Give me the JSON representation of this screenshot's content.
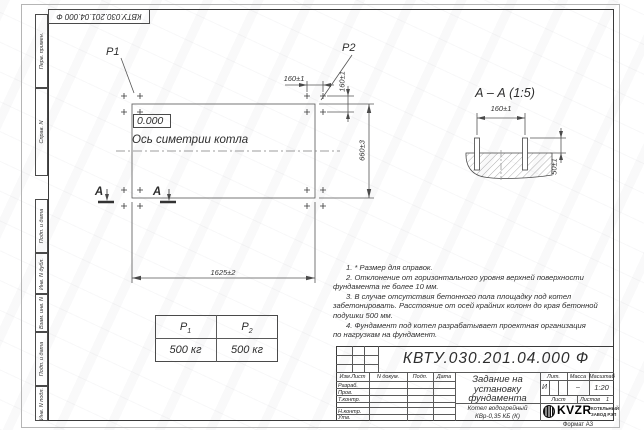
{
  "sheet": {
    "format_note": "Формат А3"
  },
  "margin_stamps": [
    "Перв. примен.",
    "Справ. N",
    "Подп. и дата",
    "Инв. N дубл.",
    "Взам. инв. N",
    "Подп. и дата",
    "Инв. N подл."
  ],
  "plan": {
    "p1_label": "P1",
    "p2_label": "P2",
    "level_mark": "0.000",
    "axis_label": "Ось симетрии котла",
    "dim_length": "1625±2",
    "dim_width": "660±3",
    "dim_bolt_h": "160±1",
    "dim_bolt_v": "160±1",
    "cut_letter": "А"
  },
  "section": {
    "title": "А – А (1:5)",
    "dim_bolt_spacing": "160±1",
    "dim_protrusion": "50±1"
  },
  "load_table": {
    "col1": {
      "base": "Р",
      "sub": "1",
      "value": "500 кг"
    },
    "col2": {
      "base": "Р",
      "sub": "2",
      "value": "500 кг"
    }
  },
  "notes": {
    "lines": [
      "1. * Размер для справок.",
      "2. Отклонение от горизонтального уровня верхней поверхности",
      "фундамента не более 10 мм.",
      "3. В случае отсутствия бетонного пола площадку под котел",
      "забетонировать. Расстояние от осей крайних колонн до края бетонной",
      "подушки 500 мм.",
      "4. Фундамент под котел разрабатывает проектная организация",
      "по нагрузкам на фундамент."
    ]
  },
  "title_block": {
    "designation": "КВТУ.030.201.04.000 Ф",
    "header": {
      "izm": "Изм.Лист",
      "doc": "N докум.",
      "sign": "Подп.",
      "date": "Дата"
    },
    "roles": [
      "Разраб.",
      "Пров.",
      "Т.контр.",
      "Н.контр.",
      "Утв."
    ],
    "doc_title_lines": [
      "Задание на",
      "установку",
      "фундамента"
    ],
    "product_lines": [
      "Котел водогрейный",
      "КВр-0,35 КБ (К)"
    ],
    "lit": {
      "label": "Лит.",
      "value": "И"
    },
    "mass": {
      "label": "Масса",
      "value": "–"
    },
    "scale": {
      "label": "Масштаб",
      "value": "1:20"
    },
    "sheet_cell": {
      "label": "Лист",
      "value": ""
    },
    "sheets_cell": {
      "label": "Листов",
      "value": "1"
    },
    "logo": {
      "name": "KVZR",
      "caption1": "КОТЕЛЬНЫЙ",
      "caption2": "ЗАВОД РЭП"
    }
  }
}
